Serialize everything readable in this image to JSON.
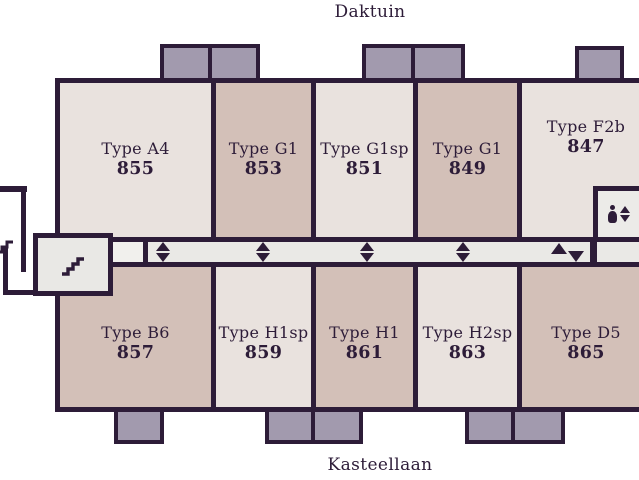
{
  "streets": {
    "top": "Daktuin",
    "bottom": "Kasteellaan"
  },
  "units": {
    "top": [
      {
        "type": "Type A4",
        "number": "855"
      },
      {
        "type": "Type G1",
        "number": "853"
      },
      {
        "type": "Type G1sp",
        "number": "851"
      },
      {
        "type": "Type G1",
        "number": "849"
      },
      {
        "type": "Type F2b",
        "number": "847"
      }
    ],
    "bottom": [
      {
        "type": "Type B6",
        "number": "857"
      },
      {
        "type": "Type H1sp",
        "number": "859"
      },
      {
        "type": "Type H1",
        "number": "861"
      },
      {
        "type": "Type H2sp",
        "number": "863"
      },
      {
        "type": "Type D5",
        "number": "865"
      }
    ]
  },
  "icons": {
    "stairwell": "stairs-icon",
    "entry_steps": "stairs-icon-small",
    "elevator": "elevator-icon",
    "unit_door": "door-marker-icon",
    "corridor_direction": "up-down-arrows-icon"
  },
  "colors": {
    "outline": "#2d1c38",
    "unit_light": "#e9e2de",
    "unit_tan": "#d3c0b8",
    "balcony": "#a29aae",
    "corridor": "#eae9e6",
    "background": "#ffffff"
  }
}
